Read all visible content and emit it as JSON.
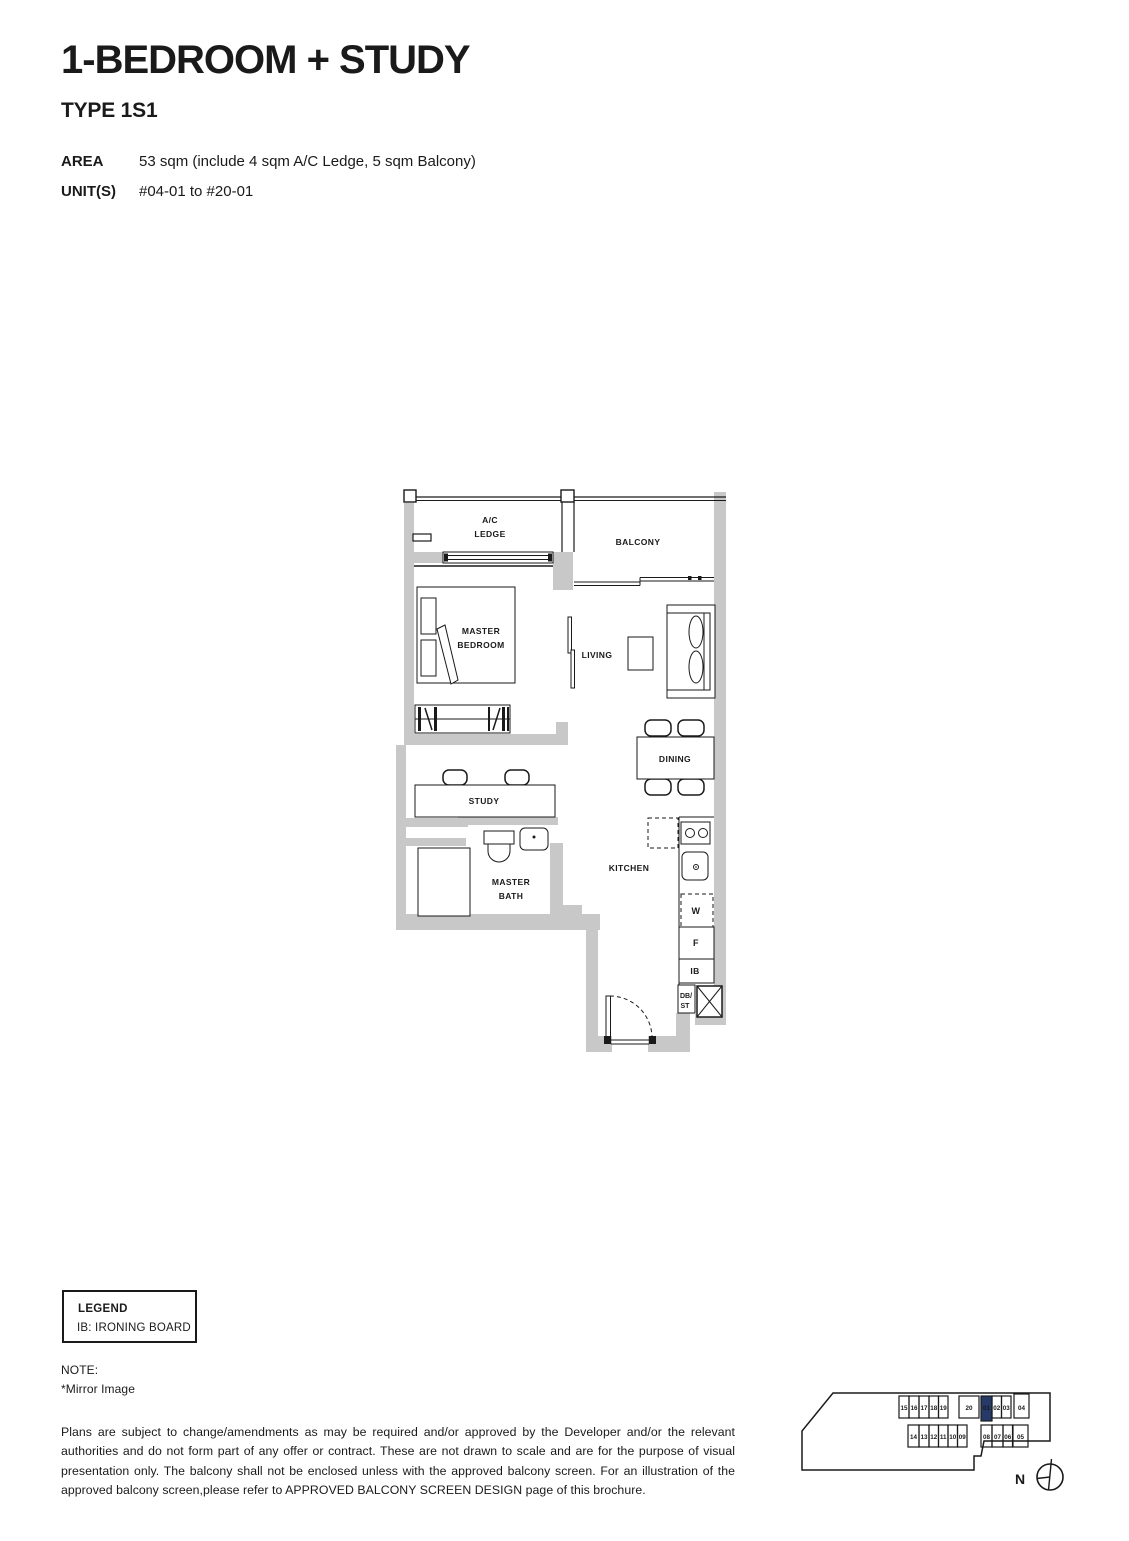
{
  "header": {
    "title": "1-BEDROOM + STUDY",
    "type": "TYPE 1S1",
    "area_label": "AREA",
    "area_value": "53 sqm (include 4 sqm A/C Ledge, 5 sqm Balcony)",
    "units_label": "UNIT(S)",
    "units_value": "#04-01 to #20-01"
  },
  "floorplan": {
    "wall_color": "#c8c8c8",
    "line_color": "#1a1a1a",
    "labels": {
      "ac_line1": "A/C",
      "ac_line2": "LEDGE",
      "balcony": "BALCONY",
      "master_line1": "MASTER",
      "master_line2": "BEDROOM",
      "living": "LIVING",
      "dining": "DINING",
      "study": "STUDY",
      "bath_line1": "MASTER",
      "bath_line2": "BATH",
      "kitchen": "KITCHEN",
      "washer": "W",
      "fridge": "F",
      "ironing_board": "IB",
      "db_line1": "DB/",
      "db_line2": "ST"
    }
  },
  "legend": {
    "title": "LEGEND",
    "item": "IB: IRONING BOARD"
  },
  "note": {
    "title": "NOTE:",
    "mirror": "*Mirror Image"
  },
  "disclaimer": "Plans are subject to change/amendments as may be required and/or approved by the Developer and/or the relevant authorities and do not form part of any offer or contract. These are not drawn to scale and are for the purpose of visual presentation only. The balcony shall not be enclosed unless with the approved balcony screen. For an illustration of the approved balcony screen,please refer to APPROVED BALCONY SCREEN DESIGN page of this brochure.",
  "minimap": {
    "north": "N",
    "highlight_color": "#263a69",
    "highlighted_unit": "01",
    "top_row": [
      "15",
      "16",
      "17",
      "18",
      "19",
      "20",
      "01",
      "02",
      "03",
      "04"
    ],
    "bottom_row": [
      "14",
      "13",
      "12",
      "11",
      "10",
      "09",
      "08",
      "07",
      "06",
      "05"
    ]
  }
}
